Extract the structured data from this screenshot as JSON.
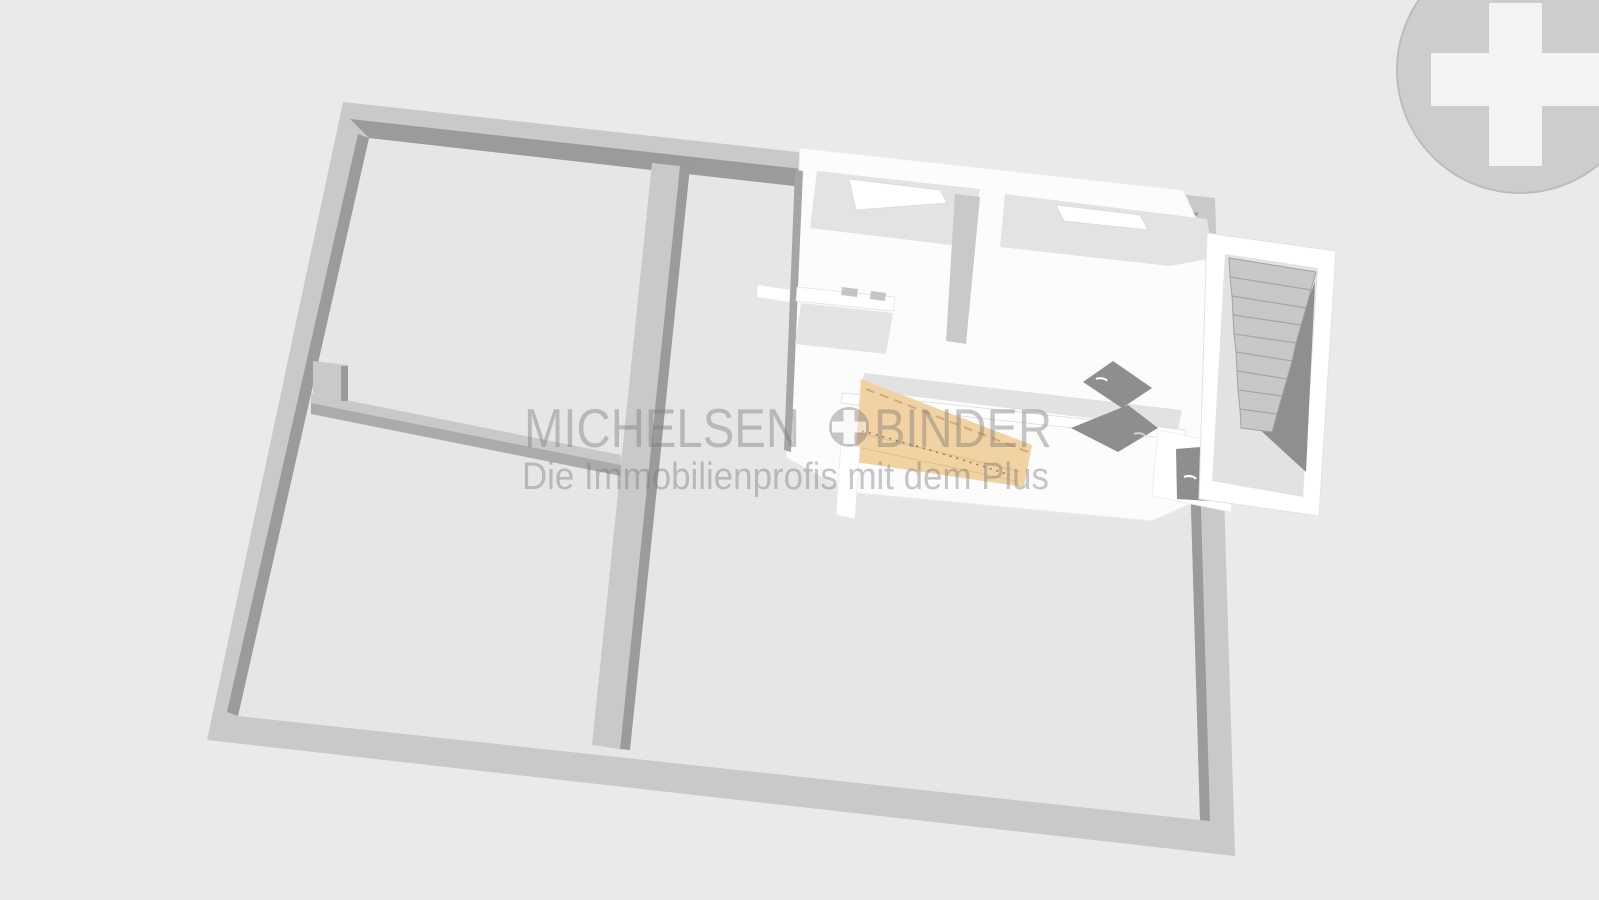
{
  "watermark": {
    "line1_left": "MICHELSEN",
    "line1_right": "BINDER",
    "line2": "Die Immobilienprofis mit dem Plus",
    "plus_icon": "plus-in-circle",
    "color": "#7a7a7a",
    "opacity": 0.42
  },
  "logo": {
    "name": "plus-cross-badge",
    "circle_color": "#cdcdcd",
    "rim_color": "#c2baba",
    "cross_color": "#f3f3f3"
  },
  "scene": {
    "type": "3d-floorplan-render",
    "background": "#eaeaea",
    "colors": {
      "floor": "#e6e6e6",
      "wall_top": "#c9c9c9",
      "wall_shadow": "#9b9b9b",
      "upper_slab": "#fcfcfc",
      "upper_wall": "#ffffff",
      "ceiling_slope": "#e3e3e3",
      "counter": "#e4e4e4",
      "fixture": "#c4c4c4",
      "hallway_band": "#e2e2e2",
      "wood_panel": "#f1d2a2",
      "wood_line": "#c49a62",
      "door_leaf": "#8e8e8e",
      "stair_tread": "#c8c8c8",
      "stair_edge": "#a2a2a2",
      "stair_shadow": "#8f8f8f",
      "stair_landing": "#e2e2e2"
    }
  }
}
